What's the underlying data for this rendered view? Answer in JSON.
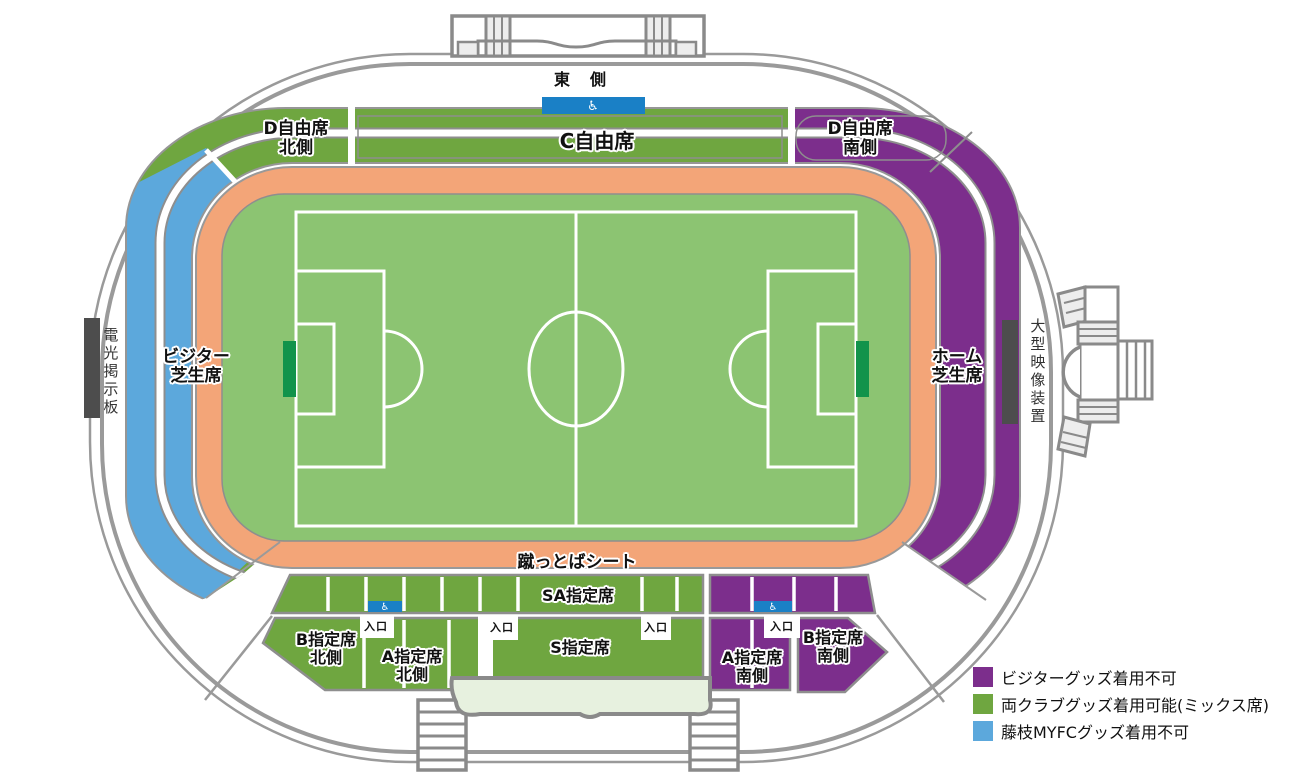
{
  "sections": {
    "east_side": {
      "label": "東　側"
    },
    "c_free": {
      "label": "C自由席",
      "category": "mixed"
    },
    "d_free_north": {
      "label": "D自由席\n北側",
      "category": "mixed"
    },
    "d_free_south": {
      "label": "D自由席\n南側",
      "category": "visitor_goods_prohibited"
    },
    "visitor_lawn": {
      "label": "ビジター\n芝生席",
      "category": "fujieda_goods_prohibited"
    },
    "home_lawn": {
      "label": "ホーム\n芝生席",
      "category": "visitor_goods_prohibited"
    },
    "kettoba_seat": {
      "label": "蹴っとばシート",
      "category": "mixed"
    },
    "sa_reserved": {
      "label": "SA指定席",
      "category": "mixed"
    },
    "s_reserved": {
      "label": "S指定席",
      "category": "mixed"
    },
    "a_reserved_north": {
      "label": "A指定席\n北側",
      "category": "mixed"
    },
    "b_reserved_north": {
      "label": "B指定席\n北側",
      "category": "mixed"
    },
    "a_reserved_south": {
      "label": "A指定席\n南側",
      "category": "visitor_goods_prohibited"
    },
    "b_reserved_south": {
      "label": "B指定席\n南側",
      "category": "visitor_goods_prohibited"
    }
  },
  "facilities": {
    "scoreboard": {
      "label": "電光掲示板"
    },
    "video_board": {
      "label": "大型映像装置"
    },
    "entrance_label": "入口",
    "wheelchair_symbol": "♿"
  },
  "legend": {
    "items": [
      {
        "key": "visitor_goods_prohibited",
        "label": "ビジターグッズ着用不可",
        "color": "#7C2E8C"
      },
      {
        "key": "mixed",
        "label": "両クラブグッズ着用可能(ミックス席)",
        "color": "#6FA640"
      },
      {
        "key": "fujieda_goods_prohibited",
        "label": "藤枝MYFCグッズ着用不可",
        "color": "#5CA8DC"
      }
    ]
  },
  "colors": {
    "visitor_goods_prohibited": "#7C2E8C",
    "mixed_seats": "#6FA640",
    "fujieda_goods_prohibited": "#5CA8DC",
    "wheelchair_box": "#1A80C6",
    "pitch": "#8CC472",
    "track": "#F3A578",
    "goal": "#12934B",
    "outline_gray": "#9A9A9A",
    "building_fill": "#E7F1DF"
  }
}
